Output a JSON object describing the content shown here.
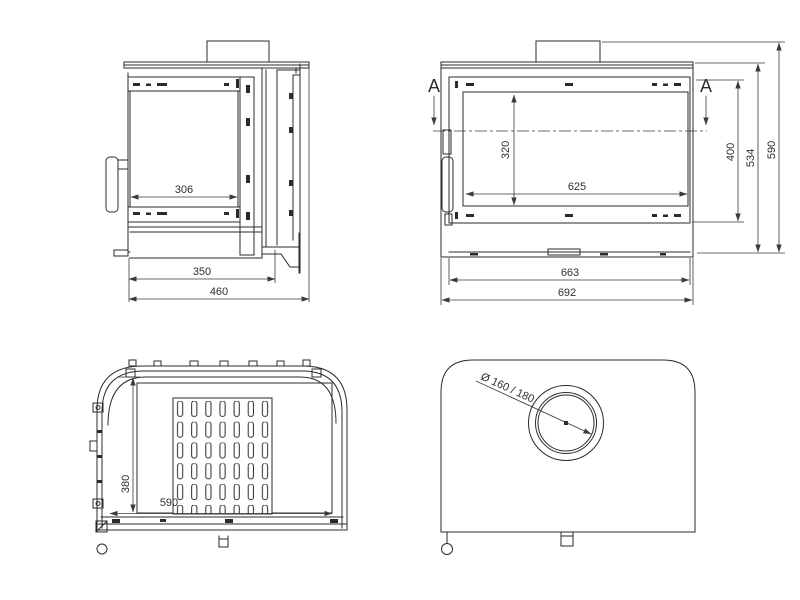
{
  "drawing": {
    "background": "#ffffff",
    "line_color": "#2b2b2b",
    "dim_color": "#3a3a3a"
  },
  "side_view": {
    "dim_glass_width": "306",
    "dim_firebox_depth": "350",
    "dim_overall_depth": "460"
  },
  "front_view": {
    "section_label_left": "A",
    "section_label_right": "A",
    "dim_glass_height": "320",
    "dim_door_height": "400",
    "dim_body_height": "534",
    "dim_overall_height": "590",
    "dim_glass_width": "625",
    "dim_inner_width": "663",
    "dim_overall_width": "692"
  },
  "section_view": {
    "dim_depth": "380",
    "dim_width": "590"
  },
  "top_view": {
    "flue_diameter_label": "Ø 160 / 180"
  }
}
